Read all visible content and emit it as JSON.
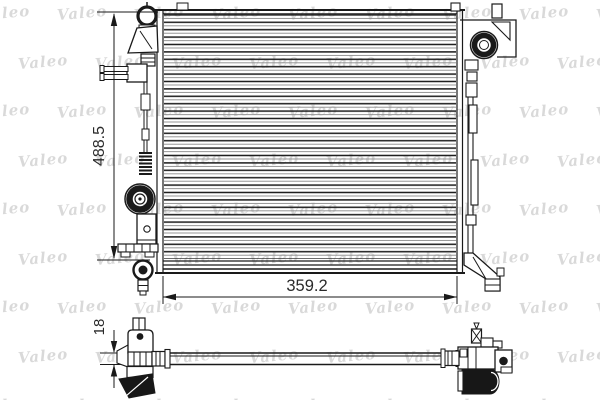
{
  "watermark": {
    "text": "Valeo",
    "color": "rgba(0,0,0,0.15)"
  },
  "colors": {
    "background": "#ffffff",
    "line": "#1a1a1a",
    "dimension_text": "#2a2a2a"
  },
  "dimensions": {
    "height_label": "488.5",
    "width_label": "359.2",
    "thickness_label": "18"
  }
}
